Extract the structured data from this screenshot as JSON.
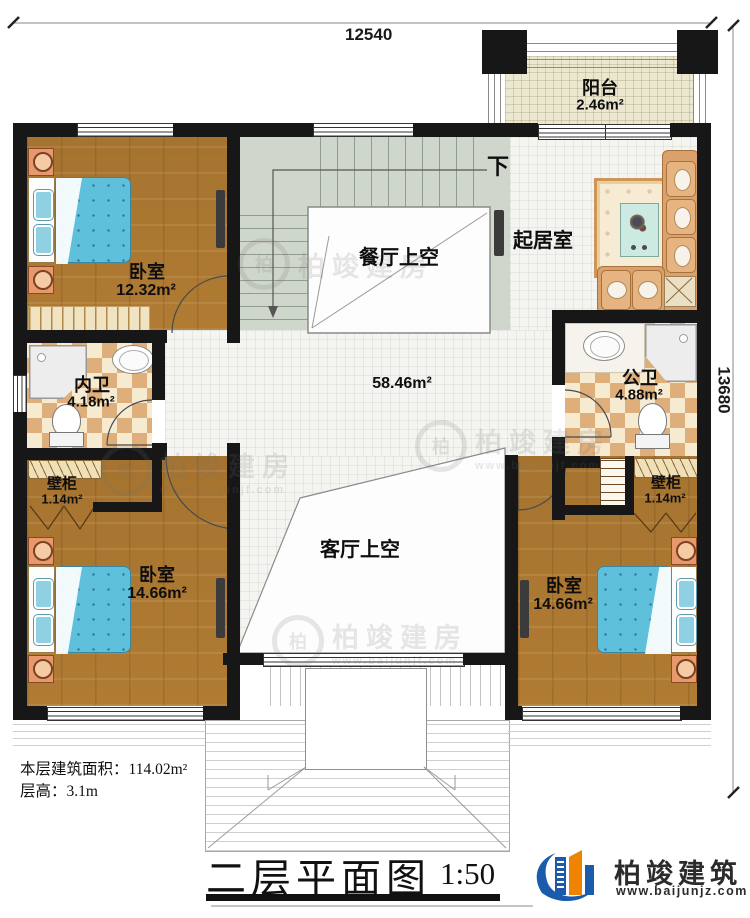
{
  "dimensions": {
    "width_mm": "12540",
    "height_mm": "13680"
  },
  "labels": {
    "down": "下"
  },
  "rooms": {
    "balcony": {
      "name": "阳台",
      "area": "2.46m²"
    },
    "bedroom_tl": {
      "name": "卧室",
      "area": "12.32m²"
    },
    "dining_void": {
      "name": "餐厅上空"
    },
    "living_room": {
      "name": "起居室"
    },
    "bath_inner": {
      "name": "内卫",
      "area": "4.18m²"
    },
    "bath_public": {
      "name": "公卫",
      "area": "4.88m²"
    },
    "hall": {
      "area": "58.46m²"
    },
    "closet_left": {
      "name": "壁柜",
      "area": "1.14m²"
    },
    "closet_right": {
      "name": "壁柜",
      "area": "1.14m²"
    },
    "bedroom_bl": {
      "name": "卧室",
      "area": "14.66m²"
    },
    "bedroom_br": {
      "name": "卧室",
      "area": "14.66m²"
    },
    "living_void": {
      "name": "客厅上空"
    }
  },
  "info": {
    "floor_area_label": "本层建筑面积：",
    "floor_area_value": "114.02m²",
    "story_height_label": "层高：",
    "story_height_value": "3.1m"
  },
  "title": {
    "text": "二层平面图",
    "scale": "1:50"
  },
  "brand": {
    "name": "柏竣建筑",
    "website": "www.baijunjz.com"
  },
  "watermark": {
    "name": "柏竣建房",
    "website": "www.baijunjf.com",
    "glyph": "柏"
  },
  "colors": {
    "wall": "#171717",
    "wood": "#b07b33",
    "bed": "#5fc0db",
    "stair": "#cfd6cc",
    "brand_blue": "#1b5bab",
    "brand_orange": "#f08300"
  }
}
